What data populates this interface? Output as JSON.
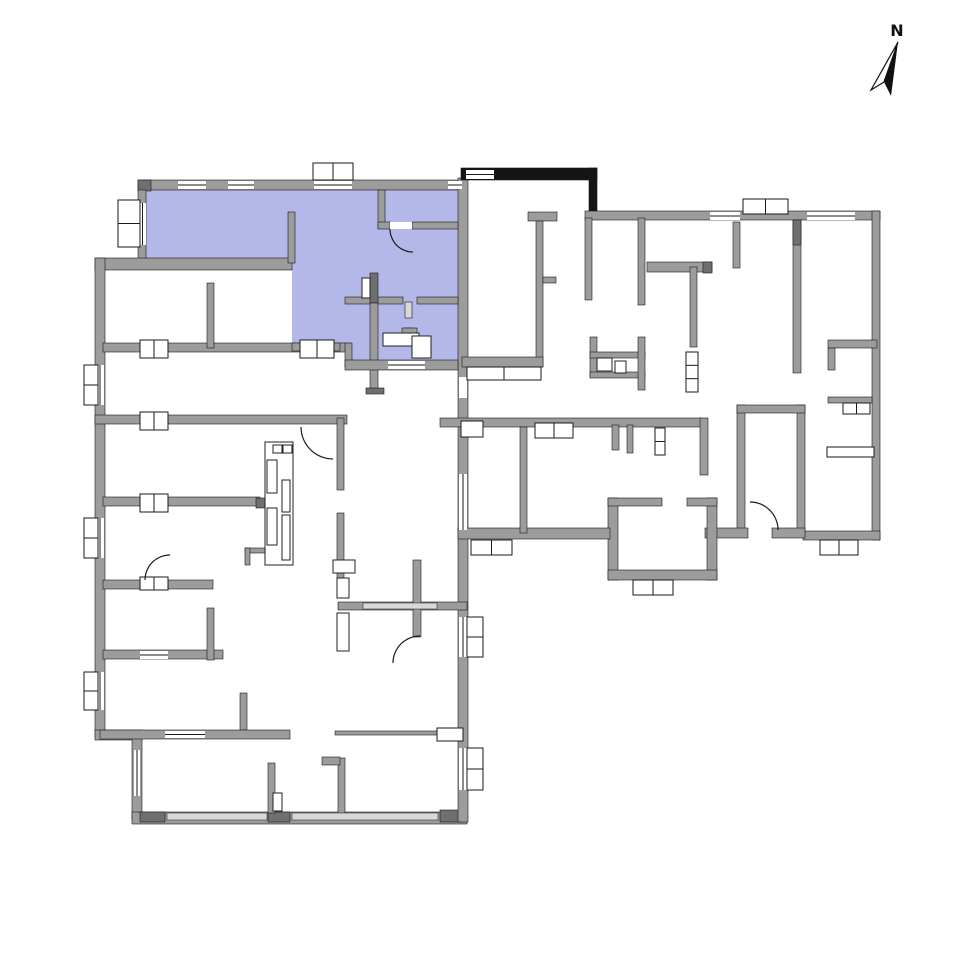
{
  "north": {
    "label": "N",
    "outline_points": [
      [
        898,
        42
      ],
      [
        871,
        90
      ],
      [
        884,
        82
      ]
    ],
    "solid_points": [
      [
        898,
        42
      ],
      [
        884,
        82
      ],
      [
        891,
        96
      ]
    ]
  },
  "colors": {
    "highlight": "#b4b8e9",
    "wall": "#9c9c9c",
    "wall_dark": "#6f6f6f",
    "wall_light": "#d8d8d8",
    "stair_black": "#141414",
    "outline": "#1a1a1a",
    "background": "#ffffff"
  },
  "plan": {
    "unit_polygon": [
      [
        146,
        190
      ],
      [
        458,
        190
      ],
      [
        458,
        360
      ],
      [
        345,
        360
      ],
      [
        345,
        343
      ],
      [
        292,
        343
      ],
      [
        292,
        263
      ],
      [
        146,
        263
      ]
    ],
    "walls": [
      [
        138,
        180,
        327,
        10,
        "w"
      ],
      [
        138,
        180,
        13,
        11,
        "d"
      ],
      [
        138,
        190,
        8,
        75,
        "w"
      ],
      [
        95,
        258,
        197,
        12,
        "w"
      ],
      [
        95,
        258,
        10,
        480,
        "w"
      ],
      [
        95,
        730,
        47,
        10,
        "w"
      ],
      [
        132,
        738,
        10,
        82,
        "w"
      ],
      [
        132,
        812,
        335,
        12,
        "w"
      ],
      [
        140,
        812,
        25,
        10,
        "d"
      ],
      [
        268,
        812,
        22,
        10,
        "d"
      ],
      [
        440,
        810,
        23,
        12,
        "d"
      ],
      [
        458,
        178,
        10,
        644,
        "w"
      ],
      [
        461,
        168,
        136,
        12,
        "b"
      ],
      [
        589,
        168,
        8,
        50,
        "b"
      ],
      [
        585,
        211,
        295,
        9,
        "w"
      ],
      [
        872,
        211,
        8,
        329,
        "w"
      ],
      [
        803,
        531,
        77,
        9,
        "w"
      ],
      [
        737,
        405,
        8,
        127,
        "w"
      ],
      [
        797,
        405,
        8,
        127,
        "w"
      ],
      [
        737,
        405,
        68,
        8,
        "w"
      ],
      [
        705,
        528,
        43,
        10,
        "w"
      ],
      [
        772,
        528,
        33,
        10,
        "w"
      ],
      [
        608,
        498,
        10,
        82,
        "w"
      ],
      [
        707,
        498,
        10,
        82,
        "w"
      ],
      [
        608,
        498,
        54,
        8,
        "w"
      ],
      [
        687,
        498,
        30,
        8,
        "w"
      ],
      [
        608,
        570,
        109,
        10,
        "w"
      ],
      [
        440,
        418,
        262,
        9,
        "w"
      ],
      [
        458,
        528,
        152,
        11,
        "w"
      ],
      [
        103,
        343,
        245,
        9,
        "w"
      ],
      [
        95,
        415,
        252,
        9,
        "w"
      ],
      [
        103,
        497,
        157,
        9,
        "w"
      ],
      [
        256,
        498,
        28,
        10,
        "d"
      ],
      [
        103,
        580,
        110,
        9,
        "w"
      ],
      [
        103,
        650,
        120,
        9,
        "w"
      ],
      [
        207,
        283,
        7,
        65,
        "w"
      ],
      [
        207,
        608,
        7,
        52,
        "w"
      ],
      [
        240,
        693,
        7,
        37,
        "w"
      ],
      [
        100,
        730,
        190,
        9,
        "w"
      ],
      [
        268,
        763,
        7,
        50,
        "w"
      ],
      [
        338,
        758,
        7,
        57,
        "w"
      ],
      [
        322,
        757,
        18,
        8,
        "w"
      ],
      [
        335,
        731,
        103,
        4,
        "w"
      ],
      [
        338,
        602,
        129,
        8,
        "w"
      ],
      [
        413,
        560,
        8,
        77,
        "w"
      ],
      [
        337,
        418,
        7,
        72,
        "w"
      ],
      [
        337,
        513,
        7,
        65,
        "w"
      ],
      [
        288,
        212,
        7,
        51,
        "w"
      ],
      [
        378,
        190,
        7,
        38,
        "w"
      ],
      [
        378,
        222,
        12,
        7,
        "w"
      ],
      [
        412,
        222,
        46,
        7,
        "w"
      ],
      [
        345,
        297,
        58,
        7,
        "w"
      ],
      [
        417,
        297,
        41,
        7,
        "w"
      ],
      [
        370,
        273,
        8,
        30,
        "d"
      ],
      [
        370,
        303,
        8,
        90,
        "w"
      ],
      [
        366,
        388,
        18,
        6,
        "d"
      ],
      [
        405,
        302,
        7,
        16,
        "l"
      ],
      [
        405,
        328,
        7,
        14,
        "l"
      ],
      [
        402,
        328,
        15,
        7,
        "w"
      ],
      [
        292,
        343,
        48,
        8,
        "w"
      ],
      [
        345,
        343,
        7,
        24,
        "w"
      ],
      [
        345,
        360,
        113,
        10,
        "w"
      ],
      [
        528,
        212,
        29,
        9,
        "w"
      ],
      [
        536,
        221,
        7,
        146,
        "w"
      ],
      [
        543,
        277,
        13,
        6,
        "w"
      ],
      [
        462,
        357,
        81,
        10,
        "w"
      ],
      [
        585,
        218,
        7,
        82,
        "w"
      ],
      [
        638,
        218,
        7,
        87,
        "w"
      ],
      [
        647,
        262,
        65,
        10,
        "w"
      ],
      [
        703,
        262,
        9,
        11,
        "d"
      ],
      [
        733,
        222,
        7,
        46,
        "w"
      ],
      [
        793,
        220,
        8,
        153,
        "w"
      ],
      [
        793,
        220,
        8,
        25,
        "d"
      ],
      [
        690,
        267,
        7,
        80,
        "w"
      ],
      [
        590,
        337,
        7,
        40,
        "w"
      ],
      [
        590,
        352,
        55,
        6,
        "w"
      ],
      [
        590,
        372,
        55,
        6,
        "w"
      ],
      [
        638,
        337,
        7,
        53,
        "w"
      ],
      [
        828,
        340,
        49,
        8,
        "w"
      ],
      [
        828,
        348,
        7,
        22,
        "w"
      ],
      [
        828,
        397,
        44,
        6,
        "w"
      ],
      [
        612,
        425,
        7,
        25,
        "w"
      ],
      [
        627,
        425,
        6,
        28,
        "w"
      ],
      [
        700,
        418,
        8,
        57,
        "w"
      ],
      [
        520,
        427,
        7,
        106,
        "w"
      ],
      [
        245,
        548,
        25,
        5,
        "w"
      ],
      [
        245,
        548,
        5,
        17,
        "w"
      ]
    ],
    "openings": [
      [
        178,
        181,
        28,
        8,
        1,
        "h"
      ],
      [
        228,
        181,
        26,
        8,
        1,
        "h"
      ],
      [
        314,
        181,
        38,
        8,
        1,
        "h"
      ],
      [
        448,
        181,
        14,
        8,
        1,
        "h"
      ],
      [
        466,
        170,
        28,
        9,
        1,
        "h"
      ],
      [
        710,
        212,
        30,
        8,
        1,
        "h"
      ],
      [
        807,
        212,
        48,
        8,
        1,
        "h"
      ],
      [
        139,
        203,
        7,
        42,
        1,
        "v"
      ],
      [
        96,
        365,
        8,
        40,
        1,
        "v"
      ],
      [
        96,
        518,
        8,
        40,
        1,
        "v"
      ],
      [
        96,
        672,
        8,
        38,
        1,
        "v"
      ],
      [
        459,
        377,
        8,
        21,
        0,
        "v"
      ],
      [
        459,
        474,
        8,
        56,
        1,
        "v"
      ],
      [
        459,
        617,
        8,
        40,
        1,
        "v"
      ],
      [
        459,
        748,
        8,
        42,
        1,
        "v"
      ],
      [
        134,
        750,
        6,
        46,
        1,
        "v"
      ],
      [
        167,
        813,
        100,
        7,
        2,
        "h"
      ],
      [
        292,
        813,
        146,
        7,
        2,
        "h"
      ],
      [
        165,
        731,
        40,
        7,
        1,
        "h"
      ],
      [
        388,
        361,
        37,
        8,
        1,
        "h"
      ],
      [
        363,
        603,
        74,
        6,
        2,
        "h"
      ],
      [
        140,
        651,
        28,
        8,
        1,
        "h"
      ],
      [
        390,
        222,
        22,
        7,
        0,
        "h"
      ]
    ],
    "windows": [
      [
        118,
        200,
        22,
        47,
        2,
        "v"
      ],
      [
        313,
        163,
        40,
        17,
        2,
        "h"
      ],
      [
        743,
        199,
        45,
        15,
        2,
        "h"
      ],
      [
        84,
        365,
        14,
        40,
        2,
        "v"
      ],
      [
        84,
        518,
        14,
        40,
        2,
        "v"
      ],
      [
        84,
        672,
        14,
        38,
        2,
        "v"
      ],
      [
        467,
        617,
        16,
        40,
        2,
        "v"
      ],
      [
        467,
        748,
        16,
        42,
        2,
        "v"
      ],
      [
        471,
        540,
        41,
        15,
        2,
        "h"
      ],
      [
        535,
        423,
        38,
        15,
        2,
        "h"
      ],
      [
        633,
        580,
        40,
        15,
        2,
        "h"
      ],
      [
        820,
        540,
        38,
        15,
        2,
        "h"
      ],
      [
        843,
        403,
        27,
        11,
        2,
        "h"
      ],
      [
        655,
        428,
        10,
        27,
        2,
        "v"
      ],
      [
        300,
        340,
        34,
        18,
        2,
        "h"
      ],
      [
        140,
        340,
        28,
        18,
        2,
        "h"
      ],
      [
        140,
        412,
        28,
        18,
        2,
        "h"
      ],
      [
        140,
        494,
        28,
        18,
        2,
        "h"
      ],
      [
        140,
        577,
        28,
        13,
        2,
        "h"
      ],
      [
        686,
        352,
        12,
        40,
        3,
        "v"
      ],
      [
        827,
        447,
        47,
        10,
        1,
        "h"
      ],
      [
        461,
        421,
        22,
        16,
        1,
        "h"
      ],
      [
        437,
        728,
        26,
        13,
        1,
        "h"
      ],
      [
        467,
        367,
        74,
        13,
        2,
        "h"
      ]
    ],
    "fixtures": [
      [
        383,
        333,
        36,
        13
      ],
      [
        412,
        336,
        19,
        22
      ],
      [
        362,
        278,
        8,
        20
      ],
      [
        597,
        358,
        15,
        13
      ],
      [
        615,
        361,
        11,
        12
      ],
      [
        265,
        442,
        28,
        123
      ],
      [
        267,
        460,
        10,
        33
      ],
      [
        282,
        480,
        8,
        32
      ],
      [
        267,
        508,
        10,
        37
      ],
      [
        282,
        515,
        8,
        45
      ],
      [
        273,
        445,
        9,
        8
      ],
      [
        283,
        445,
        9,
        8
      ],
      [
        333,
        560,
        22,
        13
      ],
      [
        337,
        578,
        12,
        20
      ],
      [
        337,
        613,
        12,
        38
      ],
      [
        273,
        793,
        9,
        18
      ]
    ],
    "doors": [
      [
        413,
        229,
        23,
        90,
        180
      ],
      [
        333,
        427,
        32,
        90,
        180
      ],
      [
        170,
        580,
        25,
        180,
        270
      ],
      [
        420,
        663,
        27,
        180,
        270
      ],
      [
        750,
        530,
        28,
        270,
        360
      ]
    ]
  }
}
